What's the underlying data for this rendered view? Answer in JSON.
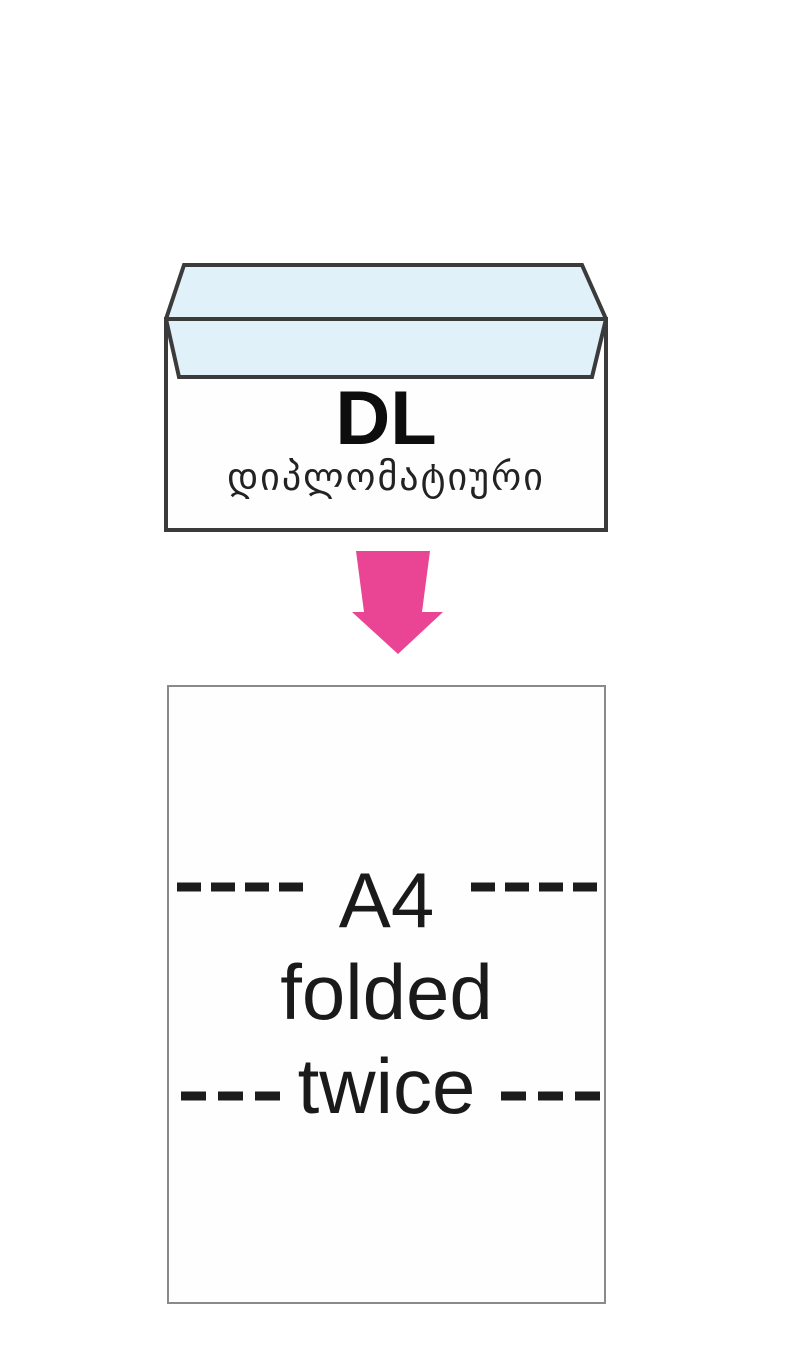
{
  "diagram": {
    "envelope": {
      "size_label": "DL",
      "type_label": "დიპლომატიური",
      "flap_color": "#e0f1fa",
      "body_color": "#fefefe",
      "border_color": "#3b3b3b"
    },
    "arrow": {
      "direction": "down",
      "color": "#ea4494"
    },
    "sheet": {
      "label_line1": "A4",
      "label_line2": "folded",
      "label_line3": "twice",
      "border_color": "#8a8a8a",
      "fold_dash_color": "#1c1c1c"
    }
  }
}
